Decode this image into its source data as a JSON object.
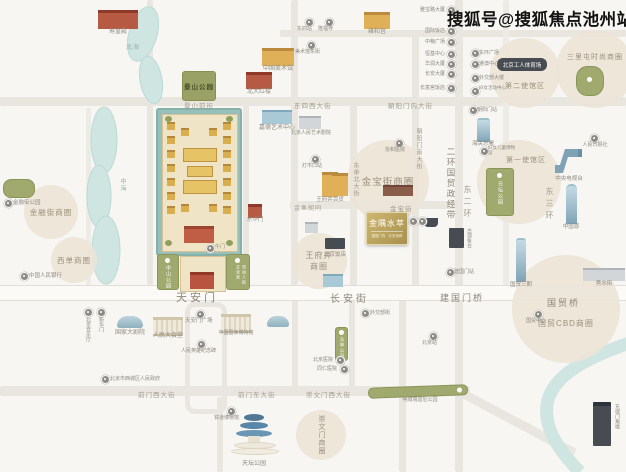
{
  "watermark": "搜狐号@搜狐焦点池州站",
  "project": {
    "name": "金隅水萃",
    "tagline": "建国门内 · 长安街畔"
  },
  "circles": {
    "jinrongjie": "金融街商圈",
    "xidan": "西单商圈",
    "jinbaojie": "金宝街商圈",
    "wfj1": "王府井",
    "wfj2": "商圈",
    "chongwenmen": "崇文门商圈",
    "sanlitun": "三里屯时尚商圈",
    "embassy2": "第二使馆区",
    "embassy1": "第一使馆区",
    "guomao": "国贸CBD商圈"
  },
  "belt": "二环国贸政经带",
  "roads": {
    "changan": "长安街",
    "tiananmen": "天安门",
    "jianguomen_qiao": "建国门桥",
    "guomao_qiao": "国贸桥",
    "jingshan_qianjie": "景山前街",
    "dongsi_xi": "东四西大街",
    "chaoyangmen_nei": "朝阳门内大街",
    "jinyu_hutong": "金鱼胡同",
    "jinbao_jie": "金宝街",
    "qianmen_xi": "前门西大街",
    "qianmen_dong": "前门东大街",
    "chongwenmen_xi": "崇文门西大街",
    "dongdan_bei": "东单北大街",
    "chaoyangmen_nan": "朝阳门南大街",
    "dong_erhuan": "东二环",
    "dong_sanhuan": "东三环"
  },
  "water": {
    "beihai": "北海",
    "zhonghai": "中海"
  },
  "parks": {
    "jingshan": "景山公园",
    "jinrongjie": "金融街公园",
    "ritan": "日坛公园",
    "dongdan": "东单公园",
    "zhongshan": "中山公园",
    "wenhuagong": "劳动人民文化宫",
    "chengqiang": "明城墙遗址公园"
  },
  "landmarks": {
    "shouhuangdian": "寿皇殿",
    "yonghegong": "雍和宫",
    "meishuguan": "中国美术馆",
    "honglou": "北大红楼",
    "jiade": "嘉德艺术中心",
    "renyi": "北京人民艺术剧院",
    "baihuo": "王府井百货",
    "beijingfandian": "北京饭店",
    "donghuamen": "东华门",
    "dajuyuan": "国家大剧院",
    "dahuitang": "人民大会堂",
    "guobo": "中国国家博物馆",
    "tiantan": "天坛公园",
    "gongti": "北京工人体育场",
    "haiguan": "海关总署",
    "guanxiangtai": "古观象台",
    "cctv": "中央电视台",
    "zhongguozun": "中国尊",
    "guomao_sanqi": "国贸三期",
    "xiushuijie": "秀水街",
    "jiaolou": "东便门角楼",
    "renminribao": "人民日报社",
    "wumen": "午门"
  },
  "markers": {
    "renminyinhang": "中国人民银行",
    "xicheng_gov": "北京市西城区人民政府",
    "yinyueting": "北京音乐厅",
    "xinhuamen": "新华门",
    "guangchang": "天安门广场",
    "jinianbei": "人民英雄纪念碑",
    "tiedao": "铁道博物馆",
    "dongsi": "东四站",
    "longfusi": "隆福寺",
    "meishuguan_dong": "美术馆东街",
    "dengshikou": "灯市口站",
    "xiehe": "协和医院",
    "waijiaobu": "外交部街",
    "beijing_yiyuan": "北京医院",
    "tongren": "同仁医院",
    "beijingzhan": "北京站",
    "chaoyangmen": "朝阳门站",
    "funv": "妇女儿童博物馆",
    "jianguomen": "建国门站",
    "guomao_center": "国贸中心"
  },
  "lists": {
    "left": [
      "雅宝路大厦",
      "国际饭店",
      "中粮广场",
      "恒基中心",
      "华润大厦",
      "长安大厦",
      "长富宫饭店"
    ],
    "right": [
      "东环广场",
      "港澳中心",
      "外交部大楼",
      "妇女活动中心"
    ]
  }
}
